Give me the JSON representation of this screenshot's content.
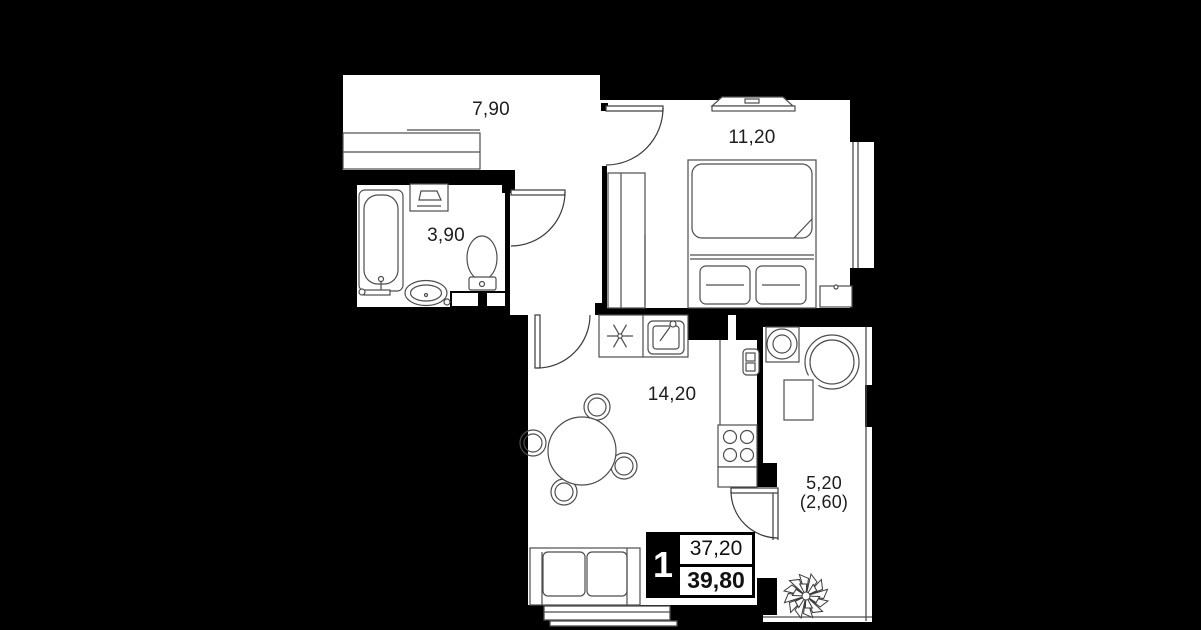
{
  "plan_title": "1-room apartment floor plan",
  "rooms": [
    {
      "name": "hallway",
      "area_label": "7,90"
    },
    {
      "name": "bedroom",
      "area_label": "11,20"
    },
    {
      "name": "bathroom",
      "area_label": "3,90"
    },
    {
      "name": "kitchen-living-room",
      "area_label": "14,20"
    },
    {
      "name": "balcony",
      "area_label": "5,20",
      "area_label_secondary": "(2,60)"
    }
  ],
  "summary_badge": {
    "room_count": "1",
    "area_top": "37,20",
    "area_bottom": "39,80"
  },
  "colors": {
    "background": "#000000",
    "floor": "#ffffff",
    "furniture_line": "#4d4d4d",
    "label_text": "#1d1d1d",
    "badge_bg": "#000000",
    "badge_text_on_dark": "#ffffff"
  },
  "icons": [
    "wardrobe-icon",
    "bathtub-icon",
    "toilet-icon",
    "sink-icon",
    "washing-machine-icon",
    "bed-icon",
    "pillow-icon",
    "nightstand-icon",
    "tv-icon",
    "hob-icon",
    "kitchen-sink-icon",
    "stove-icon",
    "radiator-icon",
    "fridge-column",
    "dining-table-icon",
    "chair-icon",
    "sofa-icon",
    "balcony-chair-icon",
    "balcony-table-icon",
    "plant-icon",
    "door-arc-icon",
    "window-icon"
  ]
}
